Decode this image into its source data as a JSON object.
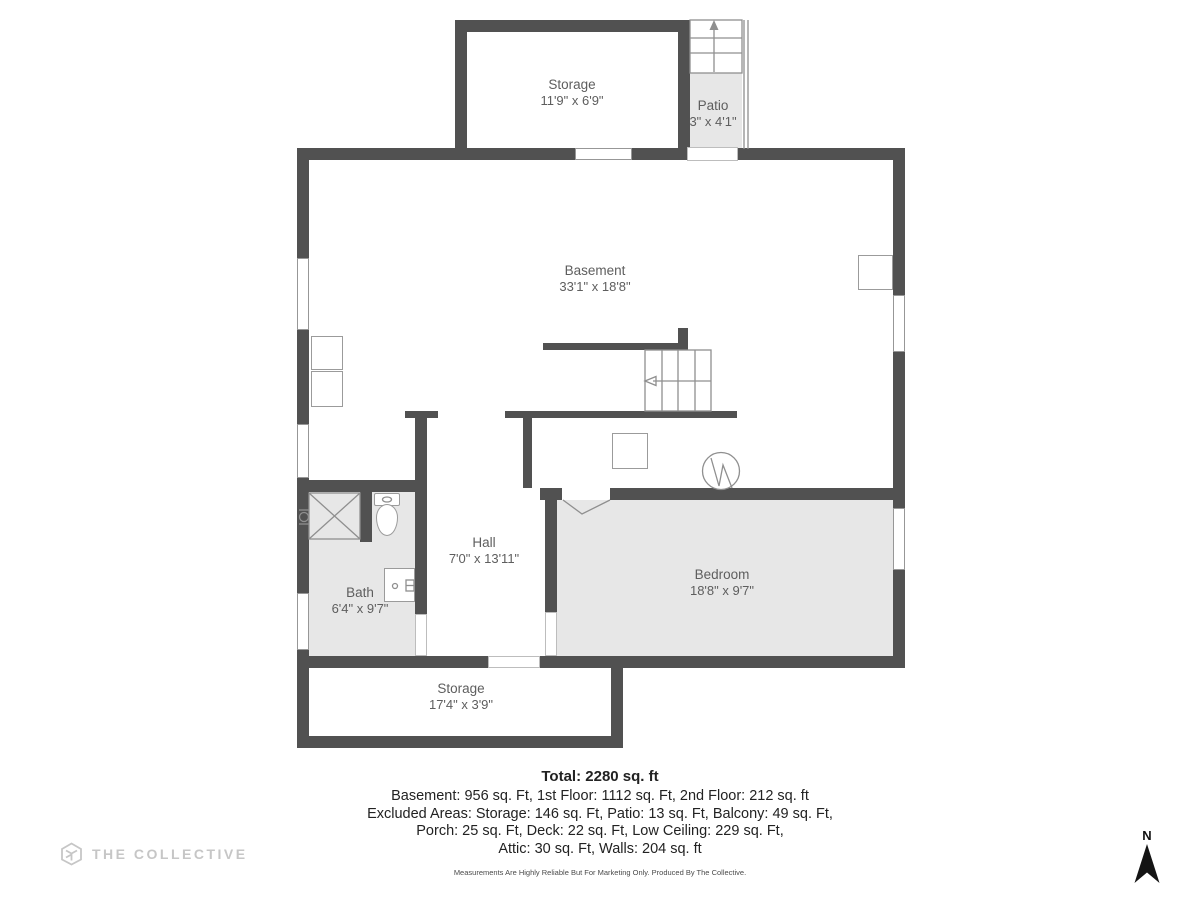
{
  "page": {
    "width": 1200,
    "height": 900,
    "background": "#ffffff"
  },
  "colors": {
    "wall": "#515151",
    "room_fill": "#e7e7e7",
    "line_art": "#8f8f8f",
    "label_text": "#5e5e5e",
    "summary_text": "#222222",
    "logo_gray": "#c6c6c6",
    "compass_black": "#141414"
  },
  "rooms": [
    {
      "name": "Storage",
      "dims": "11'9\" x 6'9\""
    },
    {
      "name": "Patio",
      "dims": "3\" x 4'1\""
    },
    {
      "name": "Basement",
      "dims": "33'1\" x 18'8\""
    },
    {
      "name": "Hall",
      "dims": "7'0\" x 13'11\""
    },
    {
      "name": "Bath",
      "dims": "6'4\" x 9'7\""
    },
    {
      "name": "Bedroom",
      "dims": "18'8\" x 9'7\""
    },
    {
      "name": "Storage",
      "dims": "17'4\" x 3'9\""
    }
  ],
  "summary": {
    "total": "Total: 2280 sq. ft",
    "lines": [
      "Basement: 956 sq. Ft, 1st Floor: 1112 sq. Ft, 2nd Floor: 212 sq. ft",
      "Excluded Areas: Storage: 146 sq. Ft, Patio: 13 sq. Ft, Balcony: 49 sq. Ft,",
      "Porch: 25 sq. Ft, Deck: 22 sq. Ft, Low Ceiling: 229 sq. Ft,",
      "Attic: 30 sq. Ft, Walls: 204 sq. ft"
    ],
    "disclaimer": "Measurements Are Highly Reliable But For Marketing Only. Produced By The Collective."
  },
  "branding": {
    "logo_text": "THE COLLECTIVE"
  },
  "compass": {
    "label": "N"
  }
}
